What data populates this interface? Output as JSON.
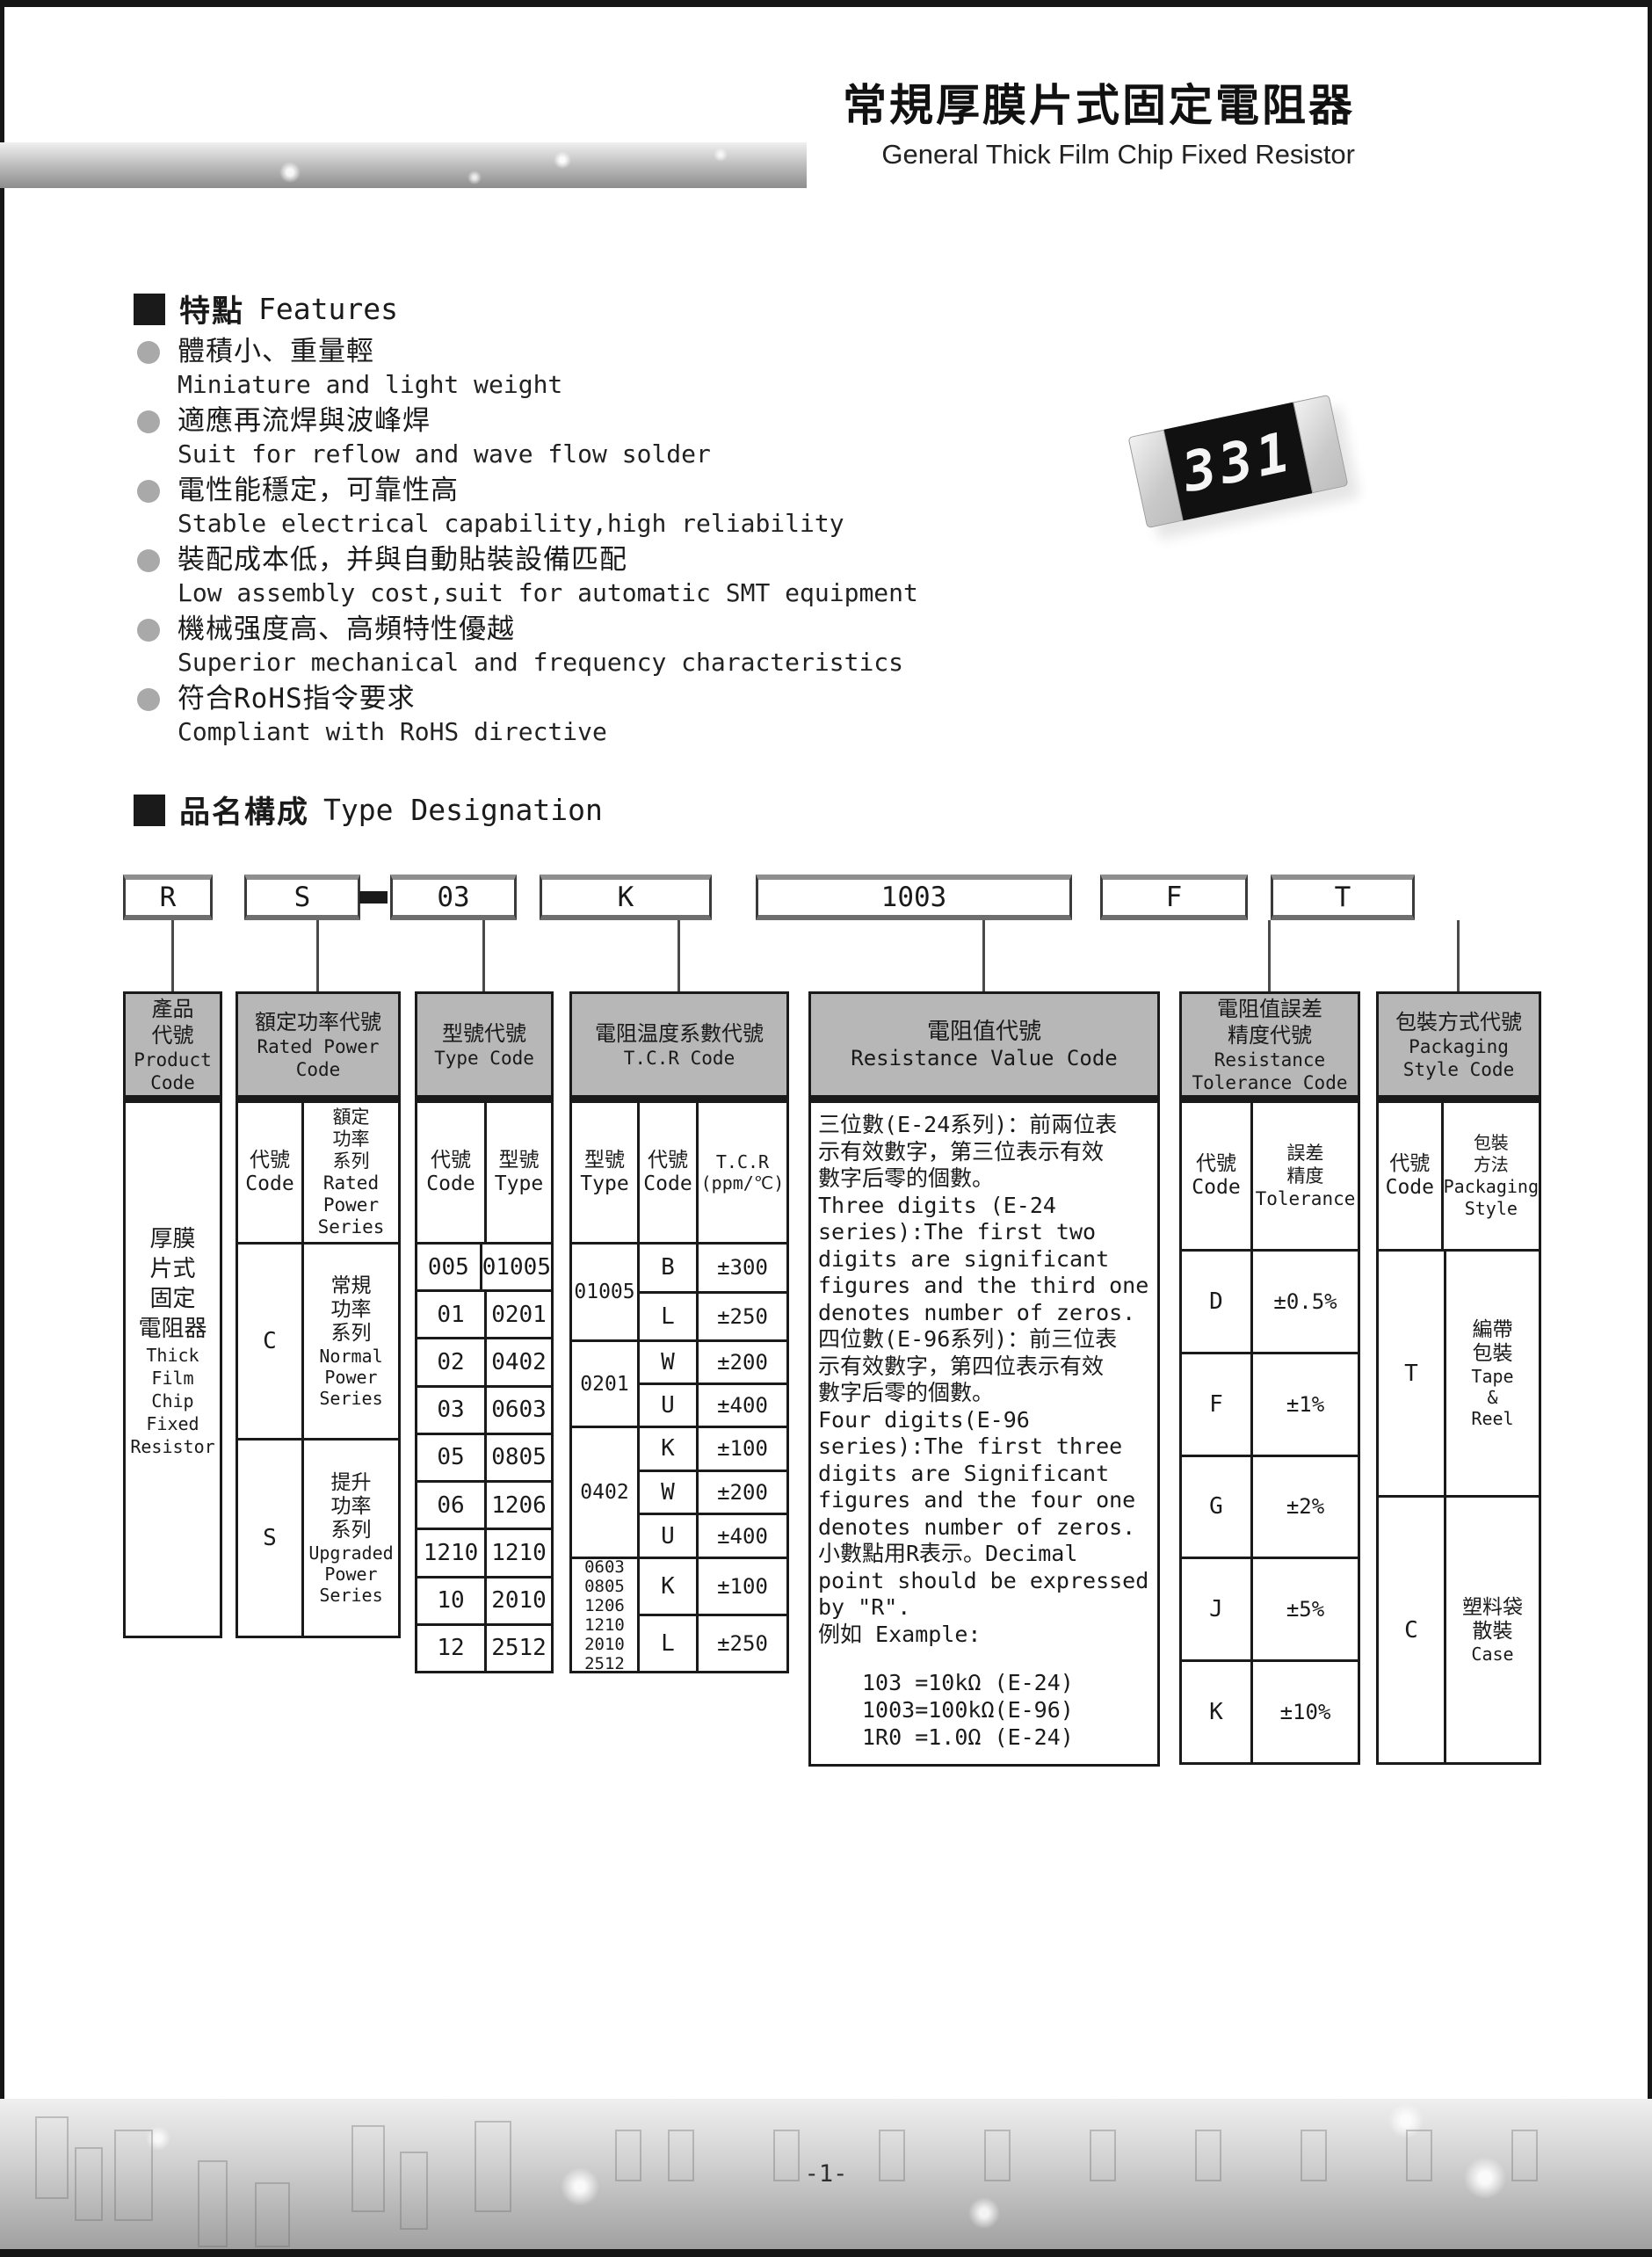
{
  "page": {
    "number": "-1-"
  },
  "header": {
    "title_zh": "常規厚膜片式固定電阻器",
    "title_en": "General Thick Film Chip Fixed Resistor"
  },
  "features": {
    "heading_zh": "特點",
    "heading_en": "Features",
    "items": [
      {
        "zh": "體積小、重量輕",
        "en": "Miniature and light weight"
      },
      {
        "zh": "適應再流焊與波峰焊",
        "en": "Suit for reflow and wave flow solder"
      },
      {
        "zh": "電性能穩定，可靠性高",
        "en": "Stable electrical capability,high reliability"
      },
      {
        "zh": "裝配成本低，并與自動貼裝設備匹配",
        "en": "Low assembly cost,suit for automatic SMT equipment"
      },
      {
        "zh": "機械强度高、高頻特性優越",
        "en": "Superior mechanical and frequency characteristics"
      },
      {
        "zh": "符合RoHS指令要求",
        "en": "Compliant with RoHS directive"
      }
    ]
  },
  "product_image": {
    "marking": "331"
  },
  "designation": {
    "heading_zh": "品名構成",
    "heading_en": "Type Designation",
    "codes": {
      "product": "R",
      "power": "S",
      "type": "03",
      "tcr": "K",
      "value": "1003",
      "tolerance": "F",
      "packaging": "T"
    },
    "columns": {
      "product": {
        "header_zh": "產品\n代號",
        "header_en": "Product\nCode",
        "body_zh": "厚膜\n片式\n固定\n電阻器",
        "body_en": "Thick\nFilm\nChip\nFixed\nResistor"
      },
      "power": {
        "header_zh": "額定功率代號",
        "header_en": "Rated Power\nCode",
        "sub_code": "代號\nCode",
        "sub_desc": "額定\n功率\n系列\nRated\nPower\nSeries",
        "rows": [
          {
            "code": "C",
            "zh": "常規\n功率\n系列",
            "en": "Normal\nPower\nSeries"
          },
          {
            "code": "S",
            "zh": "提升\n功率\n系列",
            "en": "Upgraded\nPower\nSeries"
          }
        ]
      },
      "type": {
        "header_zh": "型號代號",
        "header_en": "Type Code",
        "sub_code": "代號\nCode",
        "sub_type": "型號\nType",
        "rows": [
          [
            "005",
            "01005"
          ],
          [
            "01",
            "0201"
          ],
          [
            "02",
            "0402"
          ],
          [
            "03",
            "0603"
          ],
          [
            "05",
            "0805"
          ],
          [
            "06",
            "1206"
          ],
          [
            "1210",
            "1210"
          ],
          [
            "10",
            "2010"
          ],
          [
            "12",
            "2512"
          ]
        ]
      },
      "tcr": {
        "header_zh": "電阻温度系數代號",
        "header_en": "T.C.R Code",
        "sub_type": "型號\nType",
        "sub_code": "代號\nCode",
        "sub_tcr": "T.C.R\n(ppm/℃)",
        "groups": [
          {
            "type": "01005",
            "rows": [
              [
                "B",
                "±300"
              ],
              [
                "L",
                "±250"
              ]
            ]
          },
          {
            "type": "0201",
            "rows": [
              [
                "W",
                "±200"
              ],
              [
                "U",
                "±400"
              ]
            ]
          },
          {
            "type": "0402",
            "rows": [
              [
                "K",
                "±100"
              ],
              [
                "W",
                "±200"
              ],
              [
                "U",
                "±400"
              ]
            ]
          },
          {
            "type": "0603\n0805\n1206\n1210\n2010\n2512",
            "rows": [
              [
                "K",
                "±100"
              ],
              [
                "L",
                "±250"
              ]
            ]
          }
        ]
      },
      "value": {
        "header_zh": "電阻值代號",
        "header_en": "Resistance Value Code",
        "body": "三位數(E-24系列)：前兩位表\n示有效數字，第三位表示有效\n數字后零的個數。\nThree digits (E-24\nseries):The first two\ndigits are significant\nfigures and the third one\ndenotes number of zeros.\n四位數(E-96系列)：前三位表\n示有效數字，第四位表示有效\n數字后零的個數。\nFour digits(E-96\nseries):The first three\ndigits are Significant\nfigures and the four one\ndenotes number of zeros.\n小數點用R表示。Decimal\npoint should be expressed\nby \"R\".\n例如 Example:",
        "examples": "103 =10kΩ (E-24)\n1003=100kΩ(E-96)\n1R0 =1.0Ω (E-24)"
      },
      "tolerance": {
        "header_zh": "電阻值誤差\n精度代號",
        "header_en": "Resistance\nTolerance Code",
        "sub_code": "代號\nCode",
        "sub_desc": "誤差\n精度\nTolerance",
        "rows": [
          [
            "D",
            "±0.5%"
          ],
          [
            "F",
            "±1%"
          ],
          [
            "G",
            "±2%"
          ],
          [
            "J",
            "±5%"
          ],
          [
            "K",
            "±10%"
          ]
        ]
      },
      "packaging": {
        "header_zh": "包裝方式代號",
        "header_en": "Packaging\nStyle Code",
        "sub_code": "代號\nCode",
        "sub_desc": "包裝\n方法\nPackaging\nStyle",
        "rows": [
          {
            "code": "T",
            "zh": "編帶\n包裝",
            "en": "Tape\n&\nReel"
          },
          {
            "code": "C",
            "zh": "塑料袋\n散裝",
            "en": "Case"
          }
        ]
      }
    }
  },
  "colors": {
    "table_header_fill": "#b7b7b7",
    "ink": "#1a1a1a",
    "chip_body": "#111111"
  }
}
